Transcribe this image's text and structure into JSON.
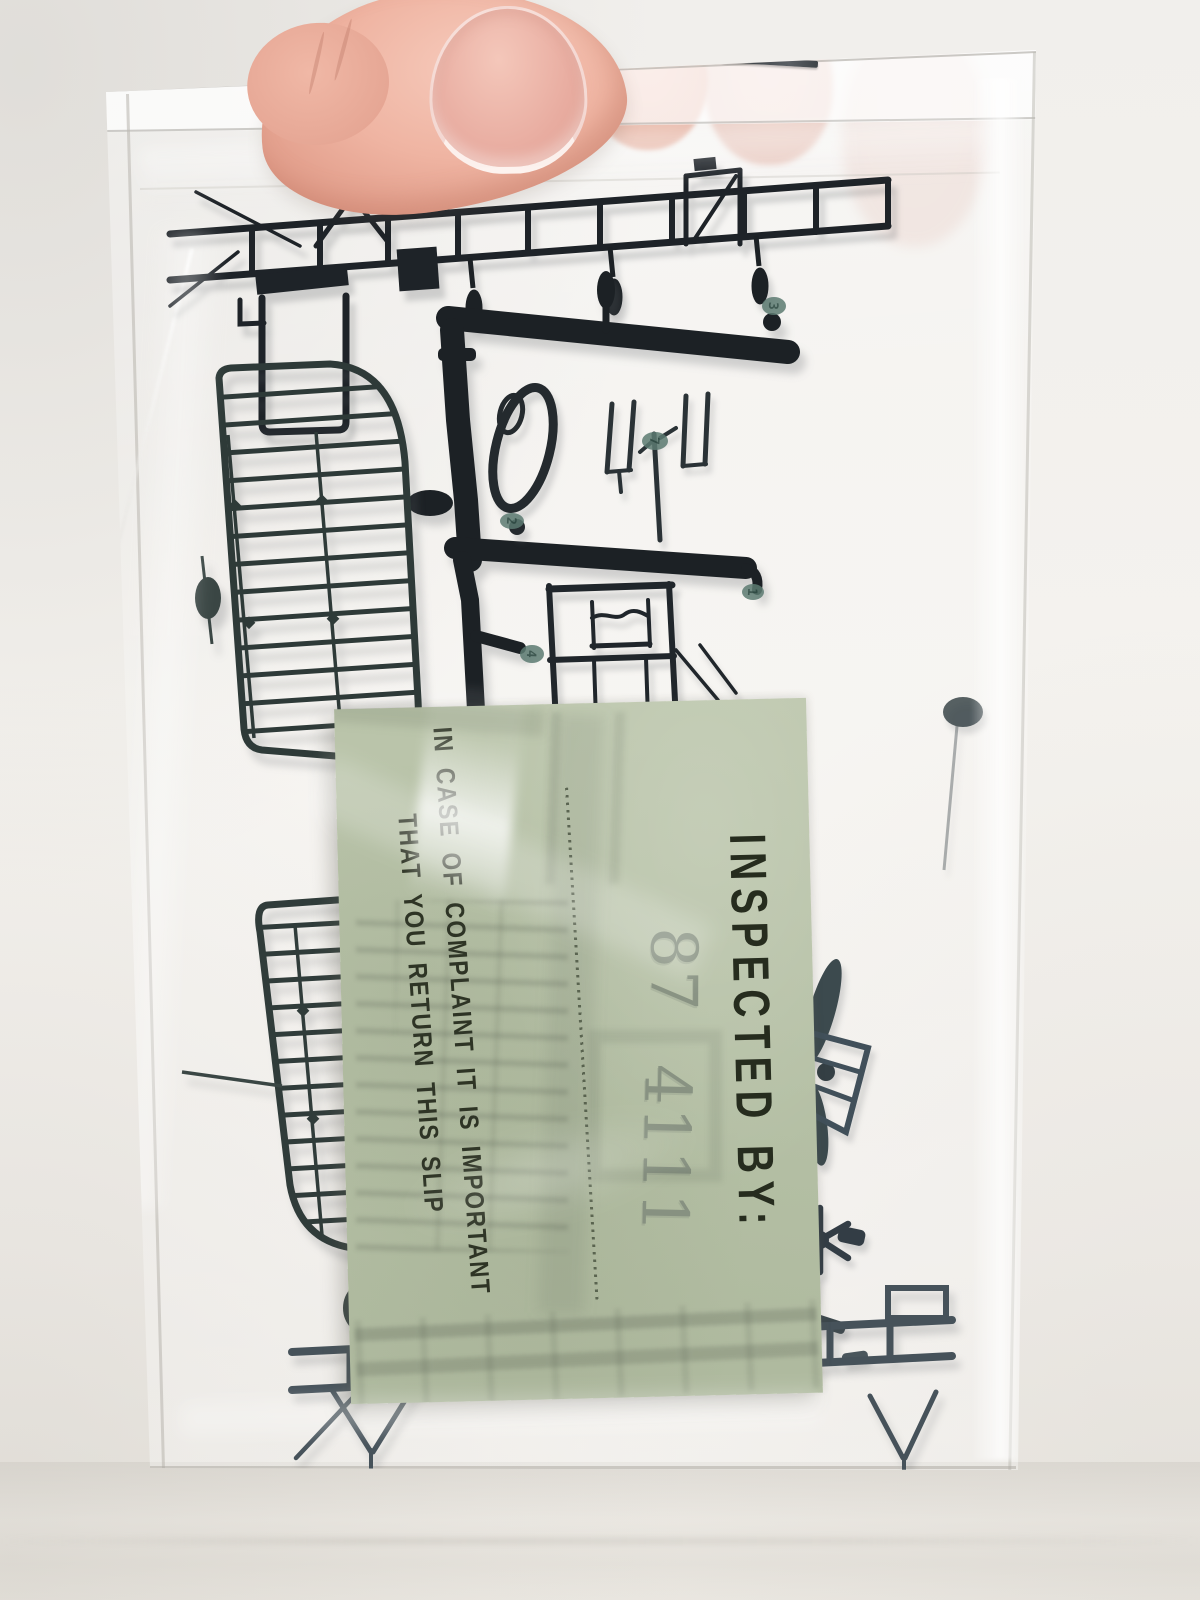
{
  "slip": {
    "title": "INSPECTED BY:",
    "stamp": {
      "left": "87",
      "right": "4111",
      "ink_color": "#7f897b"
    },
    "note_line1": "IN CASE OF COMPLAINT IT IS IMPORTANT",
    "note_line2": "THAT YOU RETURN THIS SLIP",
    "paper_color": "#b6c0a6",
    "print_color": "#262c1e"
  },
  "sprue": {
    "plastic_color": "#23282c",
    "tag_color": "#5c7a71",
    "part_tags": [
      {
        "label": "3"
      },
      {
        "label": "2"
      },
      {
        "label": "7"
      },
      {
        "label": "4"
      },
      {
        "label": "1"
      }
    ]
  },
  "bag": {
    "film_color": "#ffffff",
    "staple_color": "#53585c"
  },
  "hand": {
    "skin_color": "#eab5a3"
  },
  "background_color": "#f2efeb"
}
